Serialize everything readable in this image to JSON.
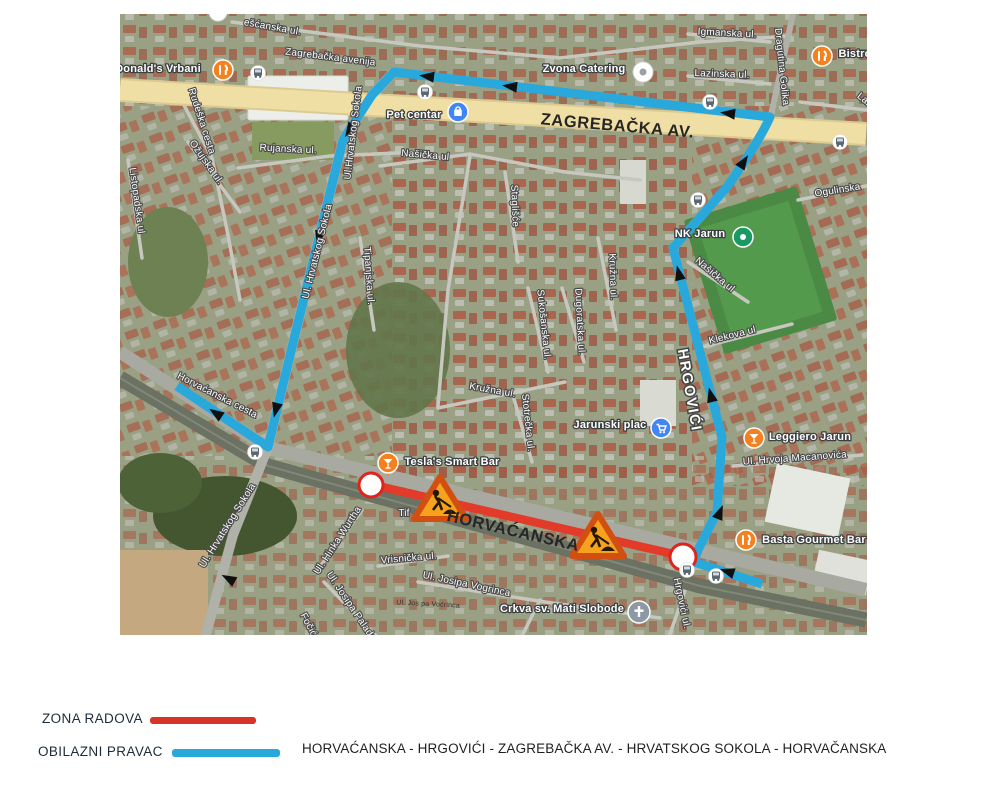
{
  "legend": {
    "work_zone_label": "ZONA RADOVA",
    "detour_label": "OBILAZNI PRAVAC",
    "route_text": "HORVAĆANSKA - HRGOVIĆI - ZAGREBAČKA AV. - HRVATSKOG SOKOLA  - HORVAČANSKA",
    "work_zone_color": "#d63429",
    "detour_color": "#29a8dc"
  },
  "map": {
    "overlays": {
      "zagrebacka_av": "ZAGREBAČKA AV.",
      "horvacanska": "HORVAĆANSKA",
      "hrgovici": "HRGOVIĆI"
    },
    "streets": {
      "pescanska": "ešćanska ul.",
      "zagrebacka_road": "Zagrebačka avenija",
      "igmanska": "Igmanska ul.",
      "lazinska": "Lazinska ul.",
      "golika": "Dragutina Golika",
      "lazi": "Lazi",
      "rudeska": "Rudeška cesta",
      "ozujska": "Ožujska ul.",
      "listopadska": "Listopadska ul",
      "rujanska": "Rujanska ul.",
      "sokola1": "Ul.Hrvatskog Sokola",
      "sokola2": "Ul. Hrvatskog Sokola",
      "sokola3": "Ul. Hrvatskog Sokola",
      "tipanjska": "Tipanjska ul.",
      "nasicka_w": "Našička ul",
      "stagliste": "Staglišće",
      "sukosanska": "Sukošanska ul.",
      "dugoratska": "Dugoratska ul.",
      "kruzna_v": "Kružna ul.",
      "kruzna_h": "Kružna ul.",
      "stotrecka": "Stotrečka ul.",
      "nasicka_e": "Našička ul",
      "klekova": "Klekova ul",
      "ogulinska": "Ogulinska",
      "horvacanska_cesta": "Horvaćanska cesta",
      "hinka_wurtha": "Ul. Hinka Wurtha",
      "vrisnicka": "Vrisnička ul.",
      "vogrinca": "Ul. Josipa Vogrinca",
      "palade": "Ul. Josipa Palade",
      "focic": "Fočić",
      "hrgovici_ul": "Hrgovići ul.",
      "tif": "Tif",
      "macanovica": "Ul. Hrvoja Macanovića",
      "vocrinca_small": "Ul. Jos pa Voćrinca"
    },
    "pois": {
      "mcdonalds": {
        "name": "Donald's Vrbani",
        "icon": "restaurant-icon"
      },
      "zvona": {
        "name": "Zvona Catering",
        "icon": "dot-icon"
      },
      "pet": {
        "name": "Pet centar",
        "icon": "shopping-icon"
      },
      "nk": {
        "name": "NK Jarun",
        "icon": "stadium-icon"
      },
      "jarunski": {
        "name": "Jarunski plac",
        "icon": "cart-icon"
      },
      "tesla": {
        "name": "Tesla's Smart Bar",
        "icon": "bar-icon"
      },
      "leggiero": {
        "name": "Leggiero Jarun",
        "icon": "bar-icon"
      },
      "basta": {
        "name": "Basta Gourmet Bar",
        "icon": "restaurant-icon"
      },
      "bistro": {
        "name": "Bistro",
        "icon": "restaurant-icon"
      },
      "crkva": {
        "name": "Crkva sv. Mati Slobode",
        "icon": "church-icon"
      }
    },
    "colors": {
      "avenue_yellow": "#efdfa5",
      "road_gray": "#a8a9a1",
      "rail_dark": "#6b7163",
      "detour_blue": "#29a8dc",
      "work_red": "#e23b2a",
      "endpoint_ring_red": "#e0241b",
      "sign_amber": "#f7a21c",
      "sign_border": "#d24f12"
    }
  }
}
